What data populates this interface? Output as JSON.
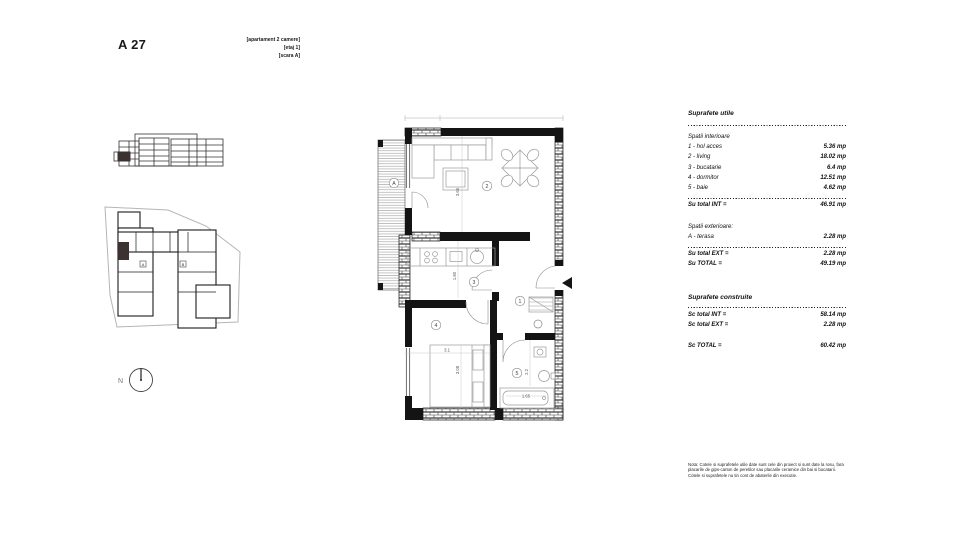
{
  "header": {
    "unit_code": "A 27",
    "tags": [
      "[apartament 2 camere]",
      "[etaj 1]",
      "[scara A]"
    ]
  },
  "site_plan": {
    "north_label": "N",
    "entrance_labels": {
      "a": "A",
      "b": "B"
    }
  },
  "plan": {
    "rooms": {
      "terrace": "A",
      "hall": "1",
      "living": "2",
      "kitchen": "3",
      "bedroom": "4",
      "bath": "5"
    },
    "dims": {
      "living": "3.65",
      "kitchen": "1.80",
      "bed_w": "3.1",
      "bed_l": "3.08",
      "bath": "2.2",
      "tub": "1.65"
    }
  },
  "tables": {
    "useful": {
      "title": "Suprafete utile",
      "interior_heading": "Spatii interioare",
      "interior_rows": [
        {
          "label": "1 - hol acces",
          "value": "5.36 mp"
        },
        {
          "label": "2 - living",
          "value": "18.02 mp"
        },
        {
          "label": "3 - bucatarie",
          "value": "6.4 mp"
        },
        {
          "label": "4 - dormitor",
          "value": "12.51 mp"
        },
        {
          "label": "5 - baie",
          "value": "4.62 mp"
        }
      ],
      "total_int": {
        "label": "Su total INT =",
        "value": "46.91 mp"
      },
      "exterior_heading": "Spatii exterioare:",
      "exterior_rows": [
        {
          "label": "A - terasa",
          "value": "2.28 mp"
        }
      ],
      "total_ext": {
        "label": "Su total EXT =",
        "value": "2.28 mp"
      },
      "total": {
        "label": "Su TOTAL =",
        "value": "49.19 mp"
      }
    },
    "built": {
      "title": "Suprafete construite",
      "rows": [
        {
          "label": "Sc total INT =",
          "value": "58.14 mp"
        },
        {
          "label": "Sc total EXT =",
          "value": "2.28 mp"
        }
      ],
      "total": {
        "label": "Sc TOTAL =",
        "value": "60.42 mp"
      }
    }
  },
  "note": "Nota: Cotele si suprafetele utile date sunt cele din proiect si sunt date la rosu, fara placarile de gips-carton de peretilor sau placarile ceramice din bai si bucatarii. Cotele si suprafetele nu tin cont de abaterile din executie."
}
